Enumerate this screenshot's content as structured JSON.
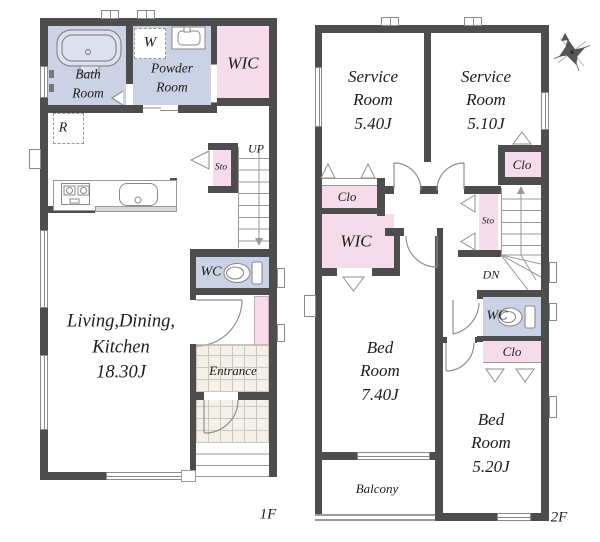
{
  "floor1": {
    "label": "1F",
    "bath": "Bath\nRoom",
    "powder": "Powder\nRoom",
    "wic": "WIC",
    "washer": "W",
    "fridge": "R",
    "storage": "Sto",
    "stairs": "UP",
    "toilet": "WC",
    "ldk": "Living,Dining,\nKitchen\n18.30J",
    "entrance": "Entrance"
  },
  "floor2": {
    "label": "2F",
    "service_a": "Service\nRoom\n5.40J",
    "service_b": "Service\nRoom\n5.10J",
    "closet_hall": "Clo",
    "wic": "WIC",
    "storage": "Sto",
    "closet_service": "Clo",
    "stairs": "DN",
    "toilet": "WC",
    "closet_bed": "Clo",
    "bed_a": "Bed\nRoom\n7.40J",
    "bed_b": "Bed\nRoom\n5.20J",
    "balcony": "Balcony"
  },
  "colors": {
    "wall": "#4d4d4d",
    "wet_room": "#ccd2e5",
    "closet": "#f6dcea"
  }
}
